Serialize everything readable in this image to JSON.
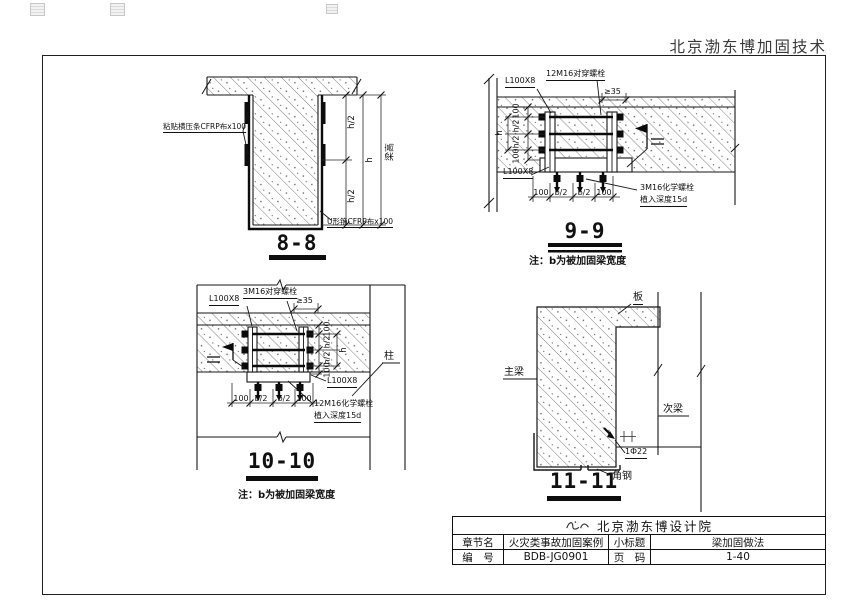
{
  "page": {
    "header_brand": "北京渤东博加固技术"
  },
  "titles": {
    "d88": "8-8",
    "d99": "9-9",
    "d1010": "10-10",
    "d1111": "11-11"
  },
  "notes": {
    "beam_width_note": "注：b为被加固梁宽度"
  },
  "d88": {
    "label_cfrp_strip": "粘贴横压条CFRP布x100",
    "label_cfrp_uwrap": "U形箍CFRP布x100",
    "dim_h2_top": "h/2",
    "dim_h2_bottom": "h/2",
    "dim_h": "h",
    "dim_beam_height": "梁高"
  },
  "d99": {
    "label_angle_top": "L100X8",
    "label_angle_bottom": "L100X8",
    "label_through_bolts": "12M16对穿螺栓",
    "label_chem_bolts": "3M16化学螺栓",
    "label_embed_depth": "植入深度15d",
    "dim_edge": "≥35",
    "dims_left": [
      "100",
      "h/2",
      "h/2",
      "100"
    ],
    "dim_h": "h",
    "dims_bottom": [
      "100",
      "b/2",
      "b/2",
      "100"
    ]
  },
  "d1010": {
    "label_angle_top": "L100X8",
    "label_angle_bottom": "L100X8",
    "label_through_bolts": "3M16对穿螺栓",
    "label_chem_bolts": "12M16化学螺栓",
    "label_embed_depth": "植入深度15d",
    "label_column": "柱",
    "dim_edge": "≥35",
    "dims_right": [
      "100",
      "h/2",
      "h/2",
      "100"
    ],
    "dim_h": "h",
    "dims_bottom": [
      "100",
      "b/2",
      "b/2",
      "100"
    ]
  },
  "d1111": {
    "label_slab": "板",
    "label_main_beam": "主梁",
    "label_secondary_beam": "次梁",
    "label_angle_steel": "角钢",
    "label_anchor": "1Ф22"
  },
  "title_block": {
    "institute": "北京渤东博设计院",
    "row_chapter": {
      "label": "章节名",
      "value": "火灾类事故加固案例"
    },
    "row_subtitle": {
      "label": "小标题",
      "value": "梁加固做法"
    },
    "row_number": {
      "label": "编　号",
      "value": "BDB-JG0901"
    },
    "row_page": {
      "label": "页　码",
      "value": "1-40"
    }
  }
}
